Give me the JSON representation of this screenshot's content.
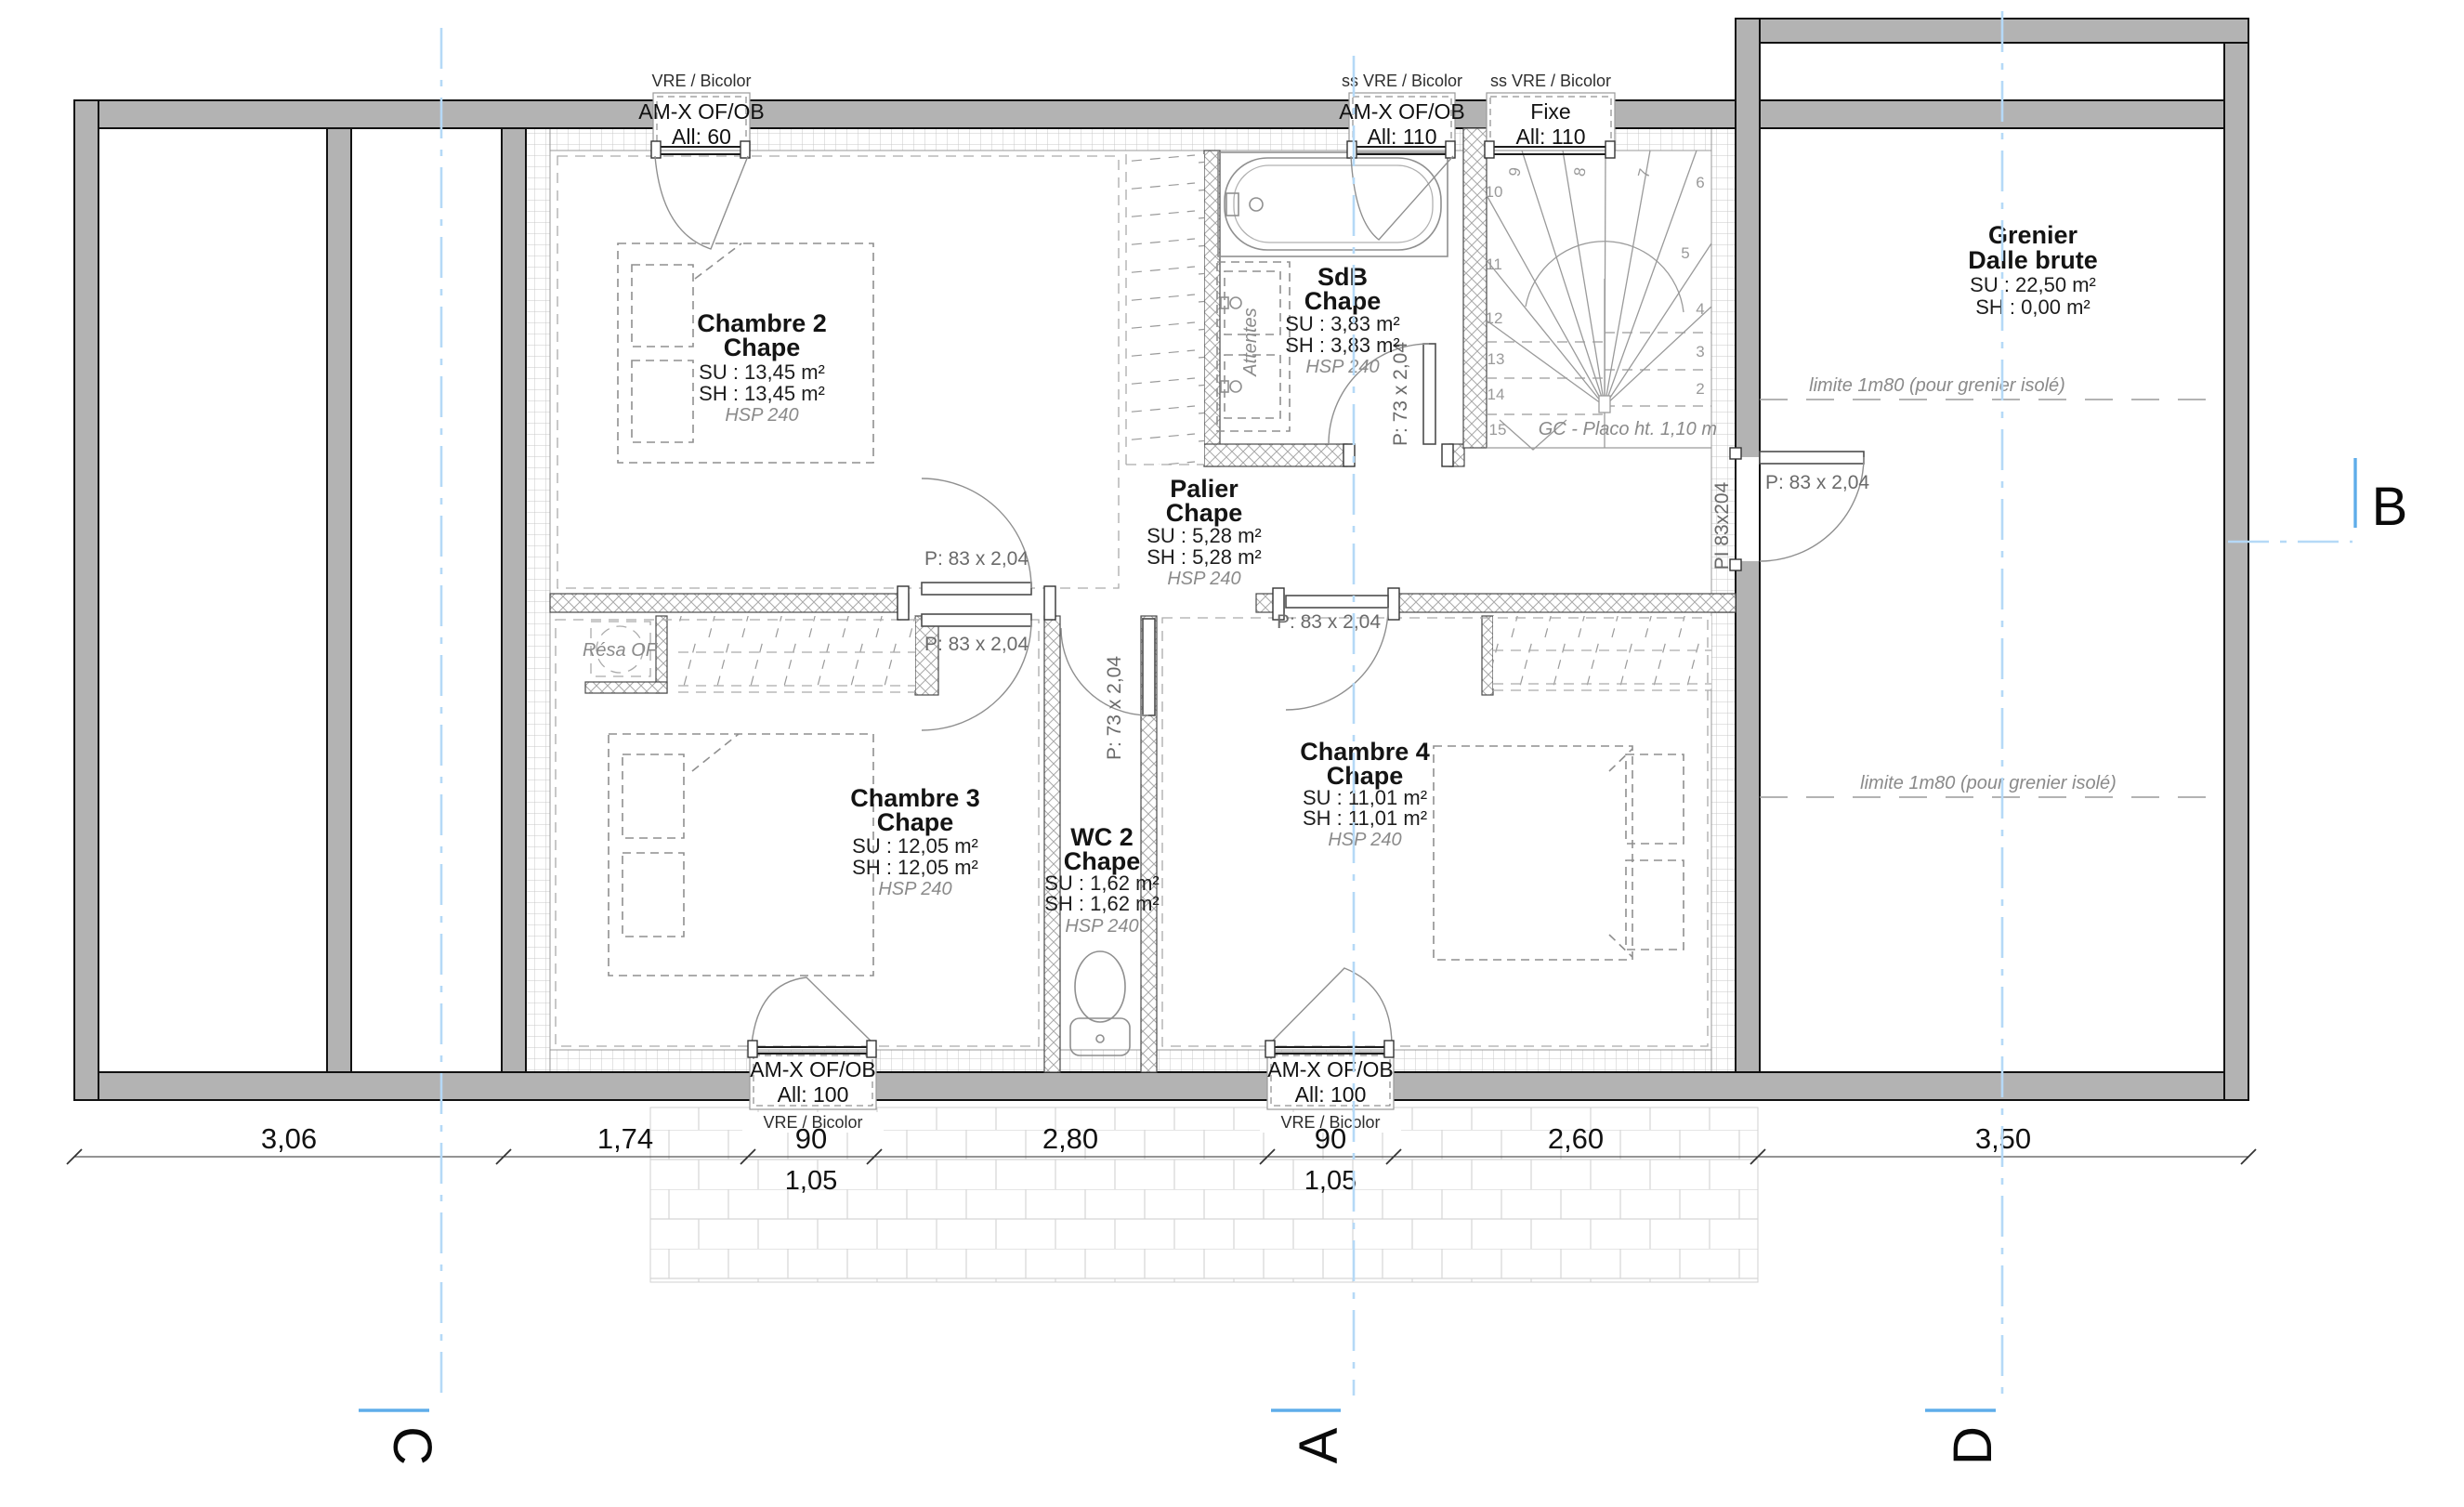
{
  "rooms": {
    "chambre2": {
      "name": "Chambre 2",
      "finish": "Chape",
      "su": "SU : 13,45 m²",
      "sh": "SH : 13,45 m²",
      "hsp": "HSP 240"
    },
    "chambre3": {
      "name": "Chambre 3",
      "finish": "Chape",
      "su": "SU : 12,05 m²",
      "sh": "SH : 12,05 m²",
      "hsp": "HSP 240"
    },
    "chambre4": {
      "name": "Chambre 4",
      "finish": "Chape",
      "su": "SU : 11,01 m²",
      "sh": "SH : 11,01 m²",
      "hsp": "HSP 240"
    },
    "sdb": {
      "name": "SdB",
      "finish": "Chape",
      "su": "SU : 3,83 m²",
      "sh": "SH : 3,83 m²",
      "hsp": "HSP 240"
    },
    "wc2": {
      "name": "WC 2",
      "finish": "Chape",
      "su": "SU : 1,62 m²",
      "sh": "SH : 1,62 m²",
      "hsp": "HSP 240"
    },
    "palier": {
      "name": "Palier",
      "finish": "Chape",
      "su": "SU : 5,28 m²",
      "sh": "SH : 5,28 m²",
      "hsp": "HSP 240"
    },
    "grenier": {
      "name": "Grenier",
      "finish": "Dalle brute",
      "su": "SU : 22,50 m²",
      "sh": "SH : 0,00 m²"
    }
  },
  "windows": {
    "top_left": {
      "header": "VRE / Bicolor",
      "type": "AM-X OF/OB",
      "allege": "All:  60"
    },
    "top_mid": {
      "header": "ss VRE / Bicolor",
      "type": "AM-X OF/OB",
      "allege": "All:  110"
    },
    "top_fixed": {
      "header": "ss VRE / Bicolor",
      "type": "Fixe",
      "allege": "All:  110"
    },
    "bottom_left": {
      "type": "AM-X OF/OB",
      "allege": "All:  100",
      "footer": "VRE / Bicolor"
    },
    "bottom_right": {
      "type": "AM-X OF/OB",
      "allege": "All:  100",
      "footer": "VRE / Bicolor"
    }
  },
  "doors": {
    "d83": "P: 83 x 2,04",
    "d73": "P: 73 x 2,04",
    "pi": "PI 83x204"
  },
  "annotations": {
    "limite": "limite 1m80 (pour grenier isolé)",
    "gc_placo": "GC - Placo ht. 1,10 m",
    "resa": "Résa OF",
    "attentes": "Attentes"
  },
  "stair": {
    "numbers": [
      "2",
      "3",
      "4",
      "5",
      "6",
      "7",
      "8",
      "9",
      "10",
      "11",
      "12",
      "13",
      "14",
      "15"
    ]
  },
  "dimensions": {
    "row": [
      "3,06",
      "1,74",
      "90",
      "2,80",
      "90",
      "2,60",
      "3,50"
    ],
    "sub": [
      "1,05",
      "1,05"
    ]
  },
  "markers": {
    "a": "A",
    "b": "B",
    "c": "C",
    "d": "D"
  }
}
